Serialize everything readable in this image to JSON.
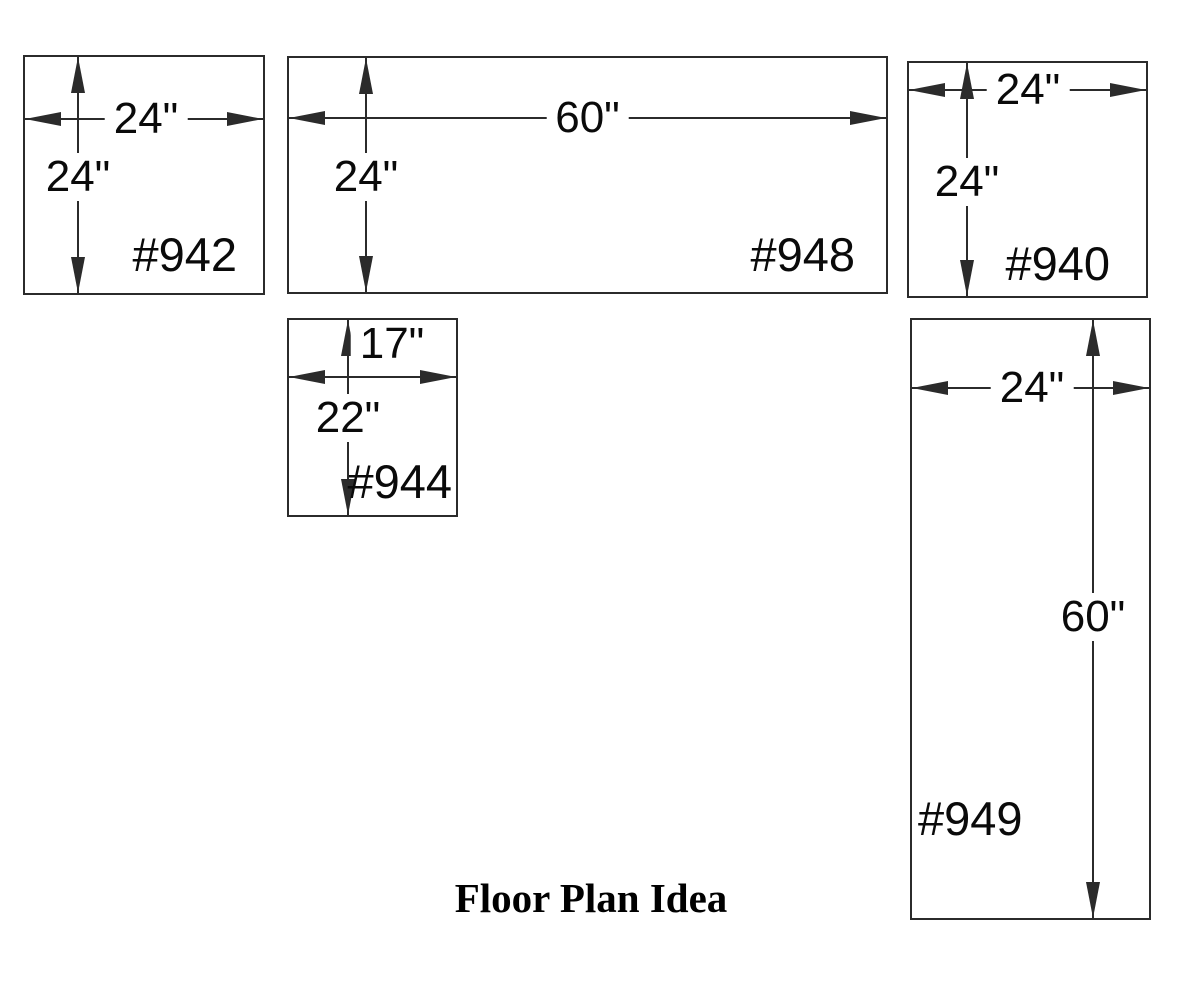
{
  "page": {
    "title": "Floor Plan Idea",
    "background_color": "#ffffff",
    "line_color": "#2b2b2b",
    "text_color": "#0a0a0a"
  },
  "units": [
    {
      "id": "942",
      "label": "#942",
      "width_label": "24\"",
      "height_label": "24\"",
      "width_inches": 24,
      "height_inches": 24
    },
    {
      "id": "948",
      "label": "#948",
      "width_label": "60\"",
      "height_label": "24\"",
      "width_inches": 60,
      "height_inches": 24
    },
    {
      "id": "940",
      "label": "#940",
      "width_label": "24\"",
      "height_label": "24\"",
      "width_inches": 24,
      "height_inches": 24
    },
    {
      "id": "944",
      "label": "#944",
      "width_label": "17\"",
      "height_label": "22\"",
      "width_inches": 17,
      "height_inches": 22
    },
    {
      "id": "949",
      "label": "#949",
      "width_label": "24\"",
      "height_label": "60\"",
      "width_inches": 24,
      "height_inches": 60
    }
  ]
}
